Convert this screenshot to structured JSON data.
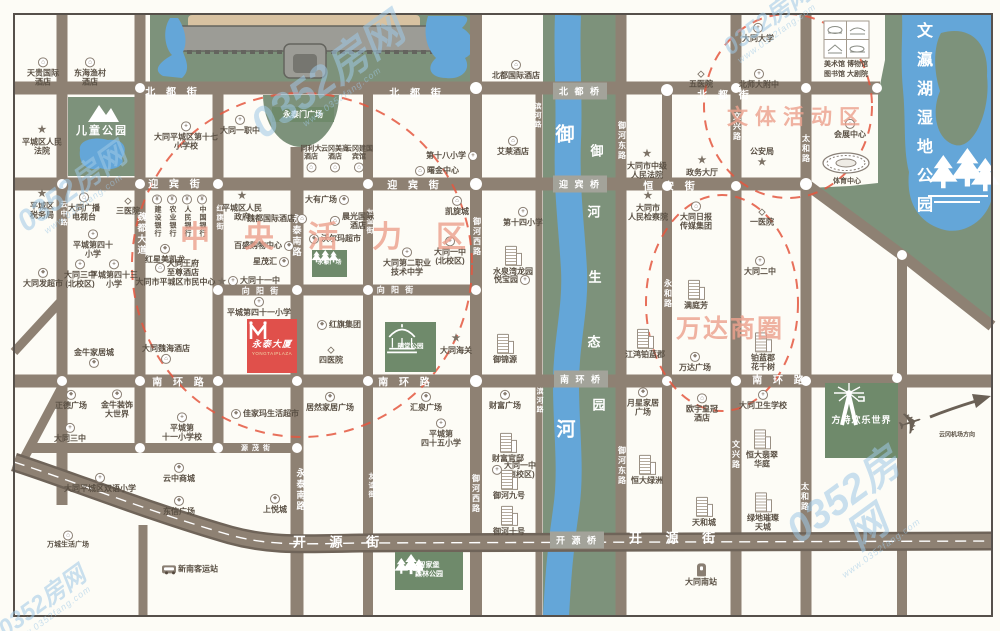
{
  "map": {
    "title": "大同平城区域示意图",
    "colors": {
      "road": "#8e8173",
      "road_edge": "#6f6459",
      "green_area": "#7d927b",
      "green_box": "#6f8a6b",
      "water": "#64a6d8",
      "palace_tan": "#d8c2a1",
      "wall_gray": "#9c9c96",
      "accent_red": "#e0504b",
      "dashed_red": "#e4573f",
      "zone_text": "#eda28f",
      "watermark": "#9fc9e6",
      "poi_text": "#5a5044"
    },
    "zones": [
      {
        "t": "中央活力区",
        "x": 180,
        "y": 234,
        "fs": 30,
        "ls": 34
      },
      {
        "t": "文体活动区",
        "x": 727,
        "y": 116,
        "fs": 21,
        "ls": 7
      },
      {
        "t": "万达商圈",
        "x": 676,
        "y": 327,
        "fs": 25,
        "ls": 2
      }
    ],
    "bridges": [
      {
        "t": "北 都 桥",
        "x": 580,
        "y": 91
      },
      {
        "t": "迎 宾 桥",
        "x": 580,
        "y": 184
      },
      {
        "t": "南 环 桥",
        "x": 581,
        "y": 379
      },
      {
        "t": "开 源 桥",
        "x": 577,
        "y": 540
      }
    ],
    "streets": {
      "h": [
        {
          "t": "北 都 街",
          "x": 173,
          "y": 91,
          "fs": 10,
          "ls": 4
        },
        {
          "t": "北 都 街",
          "x": 417,
          "y": 92,
          "fs": 10,
          "ls": 4
        },
        {
          "t": "北 都 街",
          "x": 725,
          "y": 94,
          "fs": 10,
          "ls": 4
        },
        {
          "t": "迎 宾 街",
          "x": 176,
          "y": 183,
          "fs": 10,
          "ls": 4
        },
        {
          "t": "迎 宾 街",
          "x": 415,
          "y": 184,
          "fs": 10,
          "ls": 4
        },
        {
          "t": "恒 安 街",
          "x": 671,
          "y": 185,
          "fs": 10,
          "ls": 4
        },
        {
          "t": "向 阳 街",
          "x": 261,
          "y": 291,
          "fs": 8,
          "ls": 2
        },
        {
          "t": "向 阳 街",
          "x": 396,
          "y": 290,
          "fs": 8,
          "ls": 2
        },
        {
          "t": "南 环 路",
          "x": 180,
          "y": 381,
          "fs": 10,
          "ls": 4
        },
        {
          "t": "南 环 路",
          "x": 406,
          "y": 381,
          "fs": 10,
          "ls": 4
        },
        {
          "t": "南 环 路",
          "x": 780,
          "y": 379,
          "fs": 10,
          "ls": 4
        },
        {
          "t": "源 茂 街",
          "x": 256,
          "y": 448,
          "fs": 7,
          "ls": 1
        },
        {
          "t": "开 源 街",
          "x": 341,
          "y": 541,
          "fs": 13,
          "ls": 10
        },
        {
          "t": "开 源 街",
          "x": 677,
          "y": 537,
          "fs": 13,
          "ls": 10
        }
      ],
      "v": [
        {
          "t": "云中路",
          "x": 63,
          "y": 214,
          "fs": 7
        },
        {
          "t": "魏都大道",
          "x": 142,
          "y": 234,
          "fs": 9
        },
        {
          "t": "红旗街",
          "x": 219,
          "y": 218,
          "fs": 7
        },
        {
          "t": "永泰南路",
          "x": 297,
          "y": 236,
          "fs": 9
        },
        {
          "t": "永泰南路",
          "x": 301,
          "y": 490,
          "fs": 9
        },
        {
          "t": "友谊街",
          "x": 369,
          "y": 222,
          "fs": 7
        },
        {
          "t": "友谊街",
          "x": 371,
          "y": 486,
          "fs": 7
        },
        {
          "t": "御河西路",
          "x": 477,
          "y": 237,
          "fs": 8
        },
        {
          "t": "御河西路",
          "x": 476,
          "y": 494,
          "fs": 8
        },
        {
          "t": "滨河路",
          "x": 537,
          "y": 116,
          "fs": 7
        },
        {
          "t": "滨河路",
          "x": 539,
          "y": 401,
          "fs": 7
        },
        {
          "t": "御河东路",
          "x": 622,
          "y": 141,
          "fs": 8
        },
        {
          "t": "御河东路",
          "x": 622,
          "y": 466,
          "fs": 8
        },
        {
          "t": "永和路",
          "x": 668,
          "y": 294,
          "fs": 8
        },
        {
          "t": "文兴路",
          "x": 737,
          "y": 127,
          "fs": 8
        },
        {
          "t": "文兴路",
          "x": 736,
          "y": 455,
          "fs": 8
        },
        {
          "t": "太和路",
          "x": 806,
          "y": 149,
          "fs": 8
        },
        {
          "t": "太和路",
          "x": 805,
          "y": 497,
          "fs": 8
        }
      ]
    },
    "river": {
      "name": [
        {
          "c": "御",
          "x": 565,
          "y": 133
        },
        {
          "c": "河",
          "x": 566,
          "y": 428
        }
      ],
      "park": [
        {
          "c": "御",
          "x": 597,
          "y": 150
        },
        {
          "c": "河",
          "x": 594,
          "y": 211
        },
        {
          "c": "生",
          "x": 595,
          "y": 276
        },
        {
          "c": "态",
          "x": 594,
          "y": 341
        },
        {
          "c": "园",
          "x": 599,
          "y": 404
        }
      ]
    },
    "lake": {
      "name": "文瀛湖湿地公园",
      "x": 910,
      "y": 22
    },
    "landmarks": {
      "children_park": {
        "label": "儿童公园"
      },
      "yongtaimen": {
        "label": "永泰门广场"
      },
      "yongtai_square": {
        "label": "永泰广场"
      },
      "mingtang": {
        "label": "明堂公园"
      },
      "fangte": {
        "label": "方特欢乐世界"
      },
      "zhijiabao": {
        "label": "智家堡\n森林公园"
      },
      "yongtai_plaza": {
        "name": "永泰大厦",
        "sub": "YONGTAIPLAZA"
      },
      "museums": {
        "row1": "美术馆  博物馆",
        "row2": "图书馆  大剧院"
      },
      "stadium": {
        "label": "体育中心"
      }
    },
    "pois": [
      {
        "t": "天贵国际\n酒店",
        "x": 43,
        "y": 72,
        "i": "hotel"
      },
      {
        "t": "东海渔村\n酒店",
        "x": 90,
        "y": 72,
        "i": "hotel"
      },
      {
        "t": "平城区人民\n法院",
        "x": 42,
        "y": 140,
        "i": "star"
      },
      {
        "t": "平城区\n税务局",
        "x": 42,
        "y": 204,
        "i": "star"
      },
      {
        "t": "大同广播\n电视台",
        "x": 84,
        "y": 207,
        "i": "hotel"
      },
      {
        "t": "三医院",
        "x": 128,
        "y": 206,
        "i": "hospital"
      },
      {
        "t": "大同平城区第十七\n小学校",
        "x": 186,
        "y": 136,
        "i": "school"
      },
      {
        "t": "大同一职中",
        "x": 240,
        "y": 125,
        "i": "school"
      },
      {
        "t": "同利大\n酒店",
        "x": 311,
        "y": 159,
        "i": "hotel",
        "ip": "bottom",
        "fs": 7
      },
      {
        "t": "云冈美高\n酒店",
        "x": 335,
        "y": 159,
        "i": "hotel",
        "ip": "bottom",
        "fs": 7
      },
      {
        "t": "云冈建国\n宾馆",
        "x": 359,
        "y": 159,
        "i": "hotel",
        "ip": "bottom",
        "fs": 7
      },
      {
        "t": "第十八小学",
        "x": 452,
        "y": 156,
        "i": "school",
        "ip": "right"
      },
      {
        "t": "曙金中心",
        "x": 437,
        "y": 171,
        "i": "hotel",
        "ip": "left"
      },
      {
        "t": "艾莱酒店",
        "x": 513,
        "y": 146,
        "i": "hotel"
      },
      {
        "t": "北都国际酒店",
        "x": 516,
        "y": 70,
        "i": "hotel"
      },
      {
        "t": "五医院",
        "x": 701,
        "y": 79,
        "i": "hospital"
      },
      {
        "t": "大同大学",
        "x": 758,
        "y": 33,
        "i": "school"
      },
      {
        "t": "北师大附中",
        "x": 759,
        "y": 79,
        "i": "school"
      },
      {
        "t": "会展中心",
        "x": 850,
        "y": 129,
        "i": "hotel"
      },
      {
        "t": "平城区人民\n政府",
        "x": 242,
        "y": 206,
        "i": "star"
      },
      {
        "t": "魏都国际酒店",
        "x": 277,
        "y": 219,
        "i": "hotel",
        "ip": "right"
      },
      {
        "t": "百盛购物中心",
        "x": 264,
        "y": 246,
        "i": "shop",
        "ip": "right"
      },
      {
        "t": "星茂汇",
        "x": 271,
        "y": 262,
        "i": "shop",
        "ip": "right"
      },
      {
        "t": "大同十一中",
        "x": 254,
        "y": 281,
        "i": "school",
        "ip": "left"
      },
      {
        "t": "建设银行",
        "x": 157,
        "y": 216,
        "i": "bank",
        "v": 1
      },
      {
        "t": "农业银行",
        "x": 172,
        "y": 216,
        "i": "bank",
        "v": 1
      },
      {
        "t": "人民银行",
        "x": 187,
        "y": 216,
        "i": "bank",
        "v": 1
      },
      {
        "t": "中国银行",
        "x": 202,
        "y": 216,
        "i": "bank",
        "v": 1
      },
      {
        "t": "红星美凯龙",
        "x": 165,
        "y": 254,
        "i": "shop"
      },
      {
        "t": "大同王府\n至尊酒店",
        "x": 177,
        "y": 268,
        "i": "hotel",
        "ip": "left"
      },
      {
        "t": "大同市平城区市民中心",
        "x": 181,
        "y": 282,
        "i": "star",
        "ip": "right"
      },
      {
        "t": "平城第四十\n小学",
        "x": 93,
        "y": 244,
        "i": "school"
      },
      {
        "t": "大同三中\n(北校区)",
        "x": 80,
        "y": 274,
        "i": "school"
      },
      {
        "t": "平城第四十三\n小学",
        "x": 114,
        "y": 274,
        "i": "school"
      },
      {
        "t": "大同发超市",
        "x": 43,
        "y": 278,
        "i": "shop"
      },
      {
        "t": "大有广场",
        "x": 327,
        "y": 200,
        "i": "shop",
        "ip": "right"
      },
      {
        "t": "晨光国际\n酒店",
        "x": 352,
        "y": 221,
        "i": "hotel",
        "ip": "left"
      },
      {
        "t": "沃尔玛超市",
        "x": 335,
        "y": 239,
        "i": "shop",
        "ip": "left"
      },
      {
        "t": "大同一中\n(北校区)",
        "x": 450,
        "y": 251,
        "i": "school"
      },
      {
        "t": "大同第二职业\n技术中学",
        "x": 407,
        "y": 262,
        "i": "school"
      },
      {
        "t": "凯旋城",
        "x": 457,
        "y": 206,
        "i": "hotel"
      },
      {
        "t": "第十四小学",
        "x": 523,
        "y": 217,
        "i": "school"
      },
      {
        "t": "水泉湾龙园",
        "x": 513,
        "y": 261,
        "i": "bld"
      },
      {
        "t": "悦宝园",
        "x": 512,
        "y": 280,
        "i": "school",
        "ip": "right"
      },
      {
        "t": "平城第四十一小学",
        "x": 259,
        "y": 307,
        "i": "school"
      },
      {
        "t": "红旗集团",
        "x": 339,
        "y": 325,
        "i": "shop",
        "ip": "left"
      },
      {
        "t": "四医院",
        "x": 331,
        "y": 355,
        "i": "hospital"
      },
      {
        "t": "大同魏海酒店",
        "x": 166,
        "y": 354,
        "i": "hotel",
        "ip": "bottom"
      },
      {
        "t": "金牛家居城",
        "x": 94,
        "y": 358,
        "i": "shop",
        "ip": "bottom"
      },
      {
        "t": "大同海关",
        "x": 456,
        "y": 344,
        "i": "star"
      },
      {
        "t": "御锦源",
        "x": 505,
        "y": 349,
        "i": "bld"
      },
      {
        "t": "大同市中级\n人民法院",
        "x": 647,
        "y": 164,
        "i": "star"
      },
      {
        "t": "大同市\n人民检察院",
        "x": 648,
        "y": 206,
        "i": "star"
      },
      {
        "t": "政务大厅",
        "x": 702,
        "y": 166,
        "i": "star"
      },
      {
        "t": "公安局",
        "x": 762,
        "y": 158,
        "i": "star",
        "ip": "bottom"
      },
      {
        "t": "大同日报\n传媒集团",
        "x": 696,
        "y": 216,
        "i": "hotel"
      },
      {
        "t": "一医院",
        "x": 762,
        "y": 217,
        "i": "hospital"
      },
      {
        "t": "大同二中",
        "x": 760,
        "y": 266,
        "i": "school"
      },
      {
        "t": "满庭芳",
        "x": 696,
        "y": 295,
        "i": "bld"
      },
      {
        "t": "江鸿铂蓝郡",
        "x": 645,
        "y": 344,
        "i": "bld"
      },
      {
        "t": "万达广场",
        "x": 695,
        "y": 362,
        "i": "shop"
      },
      {
        "t": "铂蓝郡\n花千树",
        "x": 763,
        "y": 352,
        "i": "bld"
      },
      {
        "t": "正德广场",
        "x": 71,
        "y": 400,
        "i": "shop"
      },
      {
        "t": "金牛装饰\n大世界",
        "x": 117,
        "y": 404,
        "i": "shop"
      },
      {
        "t": "大同三中",
        "x": 70,
        "y": 433,
        "i": "school"
      },
      {
        "t": "佳家玛生活超市",
        "x": 265,
        "y": 414,
        "i": "shop",
        "ip": "left"
      },
      {
        "t": "居然家居广场",
        "x": 330,
        "y": 402,
        "i": "shop"
      },
      {
        "t": "汇泉广场",
        "x": 426,
        "y": 402,
        "i": "shop"
      },
      {
        "t": "平城第\n四十五小学",
        "x": 441,
        "y": 433,
        "i": "school"
      },
      {
        "t": "平城第\n十一小学校",
        "x": 182,
        "y": 427,
        "i": "school"
      },
      {
        "t": "大同平城区双语小学",
        "x": 100,
        "y": 483,
        "i": "school"
      },
      {
        "t": "云中商城",
        "x": 179,
        "y": 473,
        "i": "shop"
      },
      {
        "t": "东信广场",
        "x": 179,
        "y": 506,
        "i": "shop"
      },
      {
        "t": "上悦城",
        "x": 275,
        "y": 504,
        "i": "shop"
      },
      {
        "t": "万城生活广场",
        "x": 68,
        "y": 540,
        "i": "hotel",
        "fs": 7
      },
      {
        "t": "新南客运站",
        "x": 190,
        "y": 569,
        "i": "bus",
        "ip": "left"
      },
      {
        "t": "大同一中\n(南校区)",
        "x": 514,
        "y": 470,
        "i": "school",
        "ip": "left"
      },
      {
        "t": "财富广场",
        "x": 505,
        "y": 400,
        "i": "shop"
      },
      {
        "t": "财富官邸",
        "x": 508,
        "y": 448,
        "i": "bld"
      },
      {
        "t": "御河九号",
        "x": 509,
        "y": 485,
        "i": "bld"
      },
      {
        "t": "御河十号",
        "x": 509,
        "y": 521,
        "i": "bld"
      },
      {
        "t": "月星家居\n广场",
        "x": 643,
        "y": 402,
        "i": "shop"
      },
      {
        "t": "欧宇皇冠\n酒店",
        "x": 702,
        "y": 408,
        "i": "hotel"
      },
      {
        "t": "大同卫生学校",
        "x": 763,
        "y": 400,
        "i": "school"
      },
      {
        "t": "恒大绿洲",
        "x": 647,
        "y": 470,
        "i": "bld"
      },
      {
        "t": "天和城",
        "x": 704,
        "y": 512,
        "i": "bld"
      },
      {
        "t": "恒大翡翠\n华庭",
        "x": 762,
        "y": 449,
        "i": "bld"
      },
      {
        "t": "绿地璀璨\n天城",
        "x": 763,
        "y": 512,
        "i": "bld"
      },
      {
        "t": "大同南站",
        "x": 701,
        "y": 575,
        "i": "train"
      },
      {
        "t": "云冈机场方向",
        "x": 957,
        "y": 436,
        "i": "none",
        "fs": 6
      }
    ],
    "watermarks": [
      {
        "m": "0352房网",
        "s": "www.0352fang.com",
        "x": 75,
        "y": 192,
        "fs": 30
      },
      {
        "m": "0352房网",
        "s": "www.0352fang.com",
        "x": 330,
        "y": 80,
        "fs": 42
      },
      {
        "m": "0352房网",
        "s": "www.0352fang.com",
        "x": 858,
        "y": 516,
        "fs": 40
      },
      {
        "m": "0352房网",
        "s": "www.0352fang.com",
        "x": 45,
        "y": 606,
        "fs": 24
      },
      {
        "m": "0352房网",
        "s": "www.0352fang.com",
        "x": 770,
        "y": 24,
        "fs": 24
      }
    ]
  }
}
